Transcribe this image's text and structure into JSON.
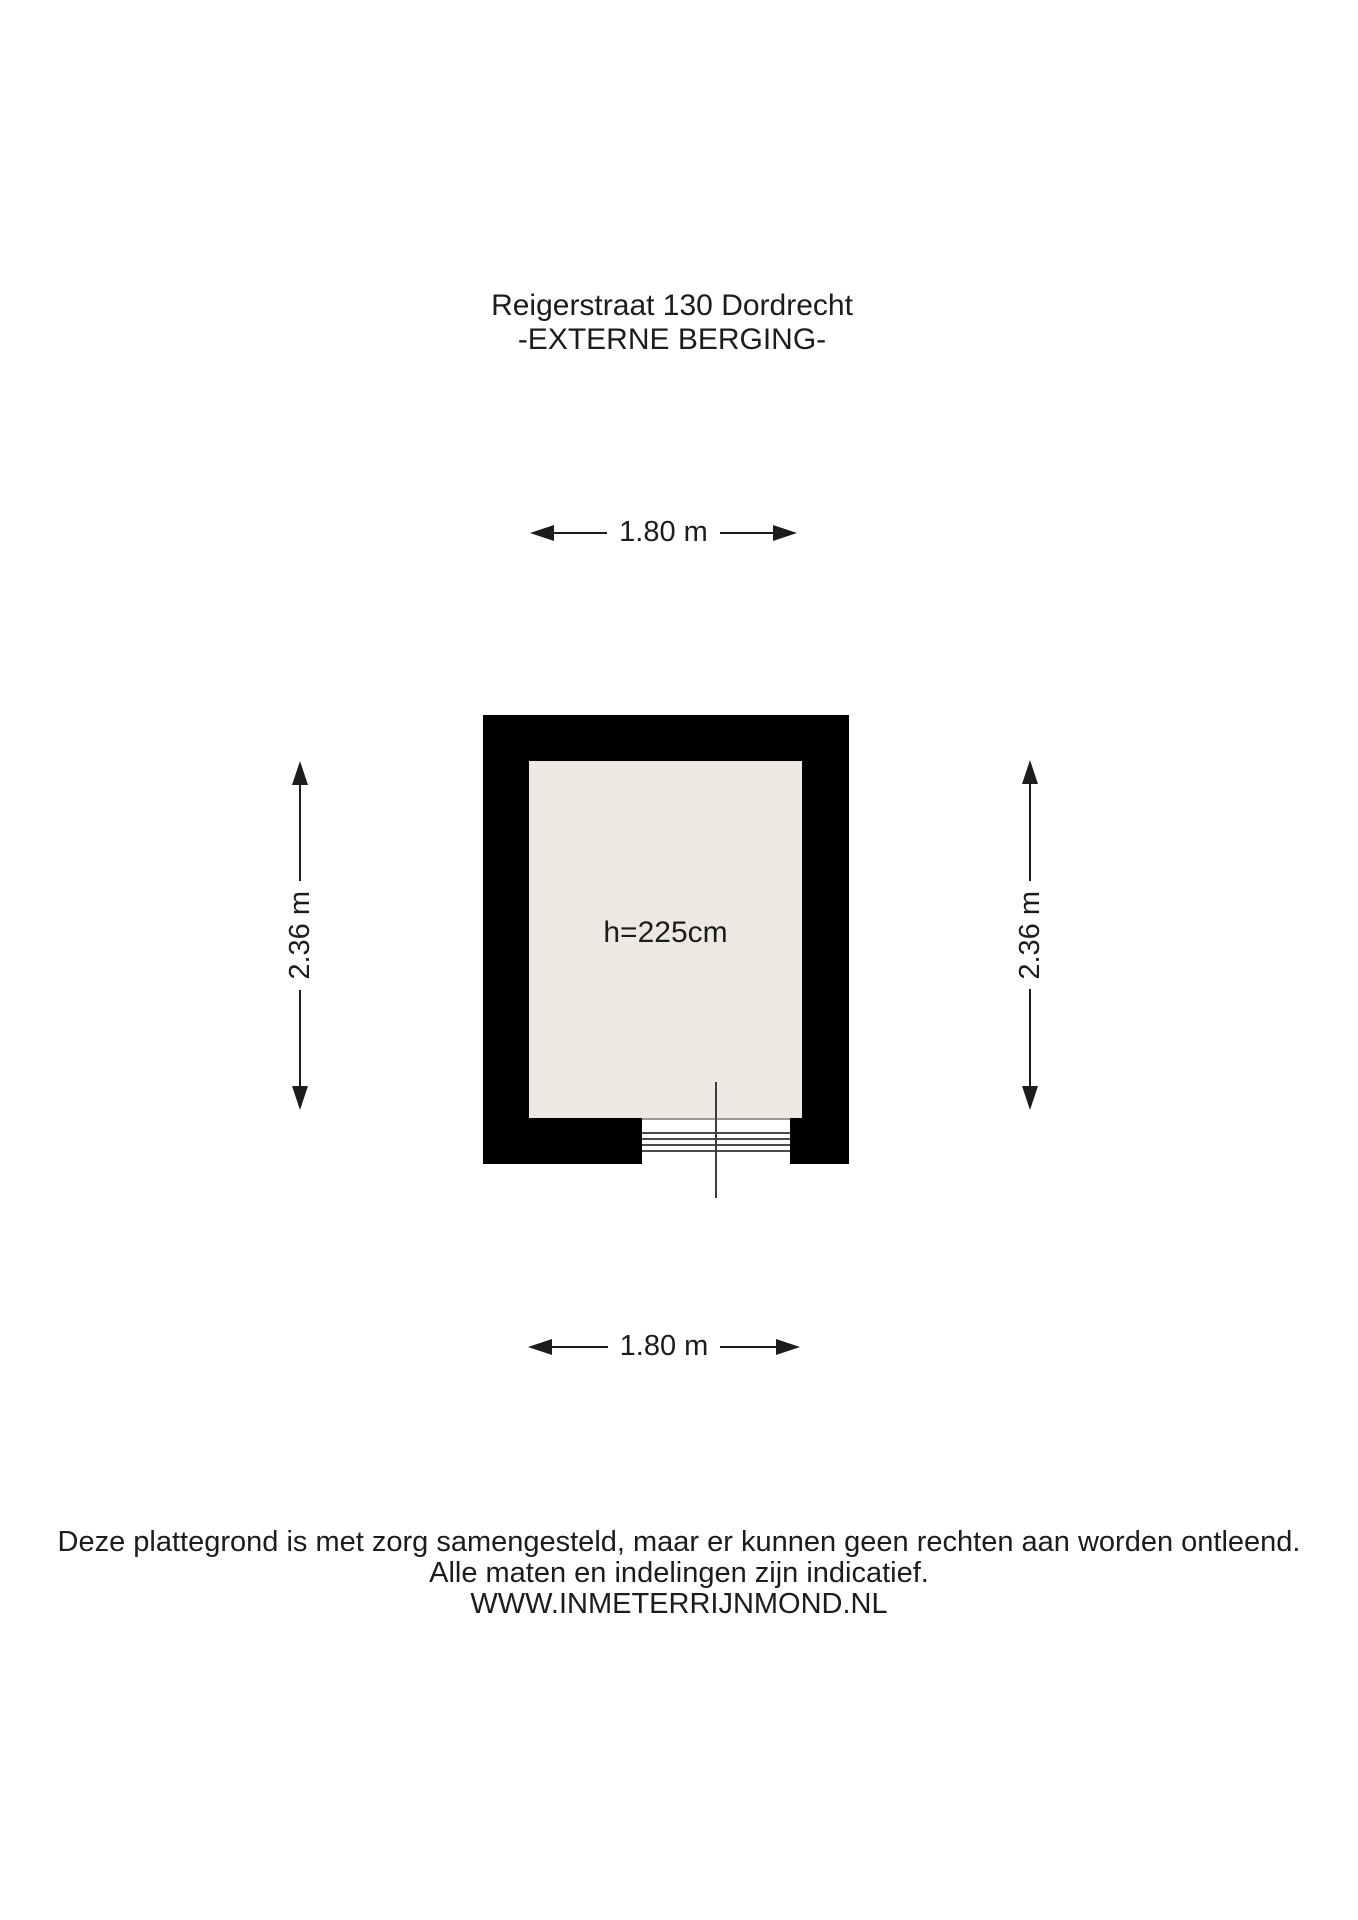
{
  "title": {
    "line1": "Reigerstraat 130 Dordrecht",
    "line2": "-EXTERNE BERGING-"
  },
  "dimensions": {
    "top": "1.80 m",
    "bottom": "1.80 m",
    "left": "2.36 m",
    "right": "2.36 m"
  },
  "room": {
    "height_label": "h=225cm"
  },
  "footer": {
    "line1": "Deze plattegrond is met zorg samengesteld, maar er kunnen geen rechten aan worden ontleend.",
    "line2": "Alle maten en indelingen zijn indicatief.",
    "line3": "WWW.INMETERRIJNMOND.NL"
  },
  "colors": {
    "wall": "#000000",
    "floor": "#ece9e2",
    "background": "#ffffff",
    "text": "#1c1c1c"
  }
}
